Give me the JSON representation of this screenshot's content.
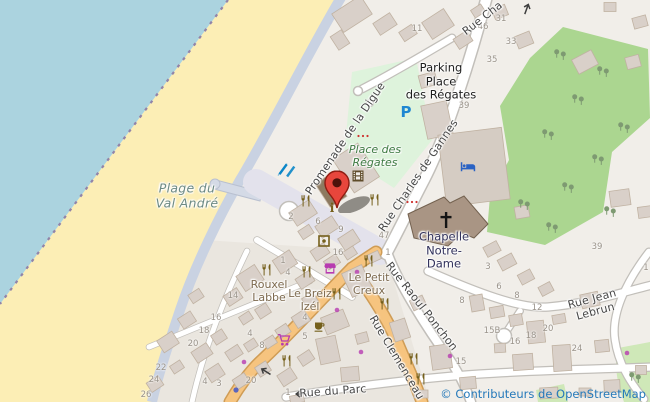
{
  "map": {
    "attribution": "© Contributeurs de OpenStreetMap",
    "colors": {
      "land": "#f1eee9",
      "water": "#abd3df",
      "sand": "#fceeb5",
      "promenade": "#c9d2e2",
      "pedestrian": "#e3e2ec",
      "building": "#d9d0c9",
      "buildingstroke": "#c0b2a2",
      "roadcasing": "#c2bfba",
      "primary": "#f6c47f",
      "primarycasing": "#cf9c55",
      "parkinglot": "#def3dc",
      "garden": "#abd690",
      "grass": "#cfe8b8",
      "boundary": "#9184a8",
      "tint": "#eae6df",
      "streettext": "#474747",
      "housenum": "#9a938a",
      "poibrown": "#7d6a4f",
      "parktext": "#3e7a42",
      "beachtext": "#6d8a84",
      "chapeltext": "#32325c",
      "attr": "#2579ba",
      "gastro": "#75601c",
      "shopmag": "#b73bb0",
      "bedblue": "#2a62c4",
      "sailblue": "#0b86c8",
      "parkblue": "#1f87d2",
      "cinema": "#5f4c2a",
      "treegreen": "#7e9a72",
      "markerred": "#e8463c",
      "markerstroke": "#8f1d12",
      "markerinner": "#4e120b"
    },
    "streets": [
      {
        "name": "Promenade de la Digue"
      },
      {
        "name": "Rue Charles de Gannes"
      },
      {
        "name": "Rue Cha"
      },
      {
        "name": "Rue Raoul Ponchon"
      },
      {
        "name": "Rue Clemenceau"
      },
      {
        "name": "Rue Jean Lebrun"
      },
      {
        "name": "Rue du Parc"
      }
    ],
    "places": [
      {
        "name": "Plage du\nVal André"
      },
      {
        "name": "Parking\nPlace\ndes Régates"
      },
      {
        "name": "Place des\nRégates"
      },
      {
        "name": "Chapelle\nNotre-\nDame"
      },
      {
        "name": "Rouxel\nLabbe"
      },
      {
        "name": "Le Breiz\nIzél"
      },
      {
        "name": "Le Petit\nCreux"
      }
    ],
    "house_numbers": [
      {
        "t": "11",
        "x": 417,
        "y": 29
      },
      {
        "t": "46",
        "x": 483,
        "y": 27
      },
      {
        "t": "31",
        "x": 501,
        "y": 19
      },
      {
        "t": "33",
        "x": 511,
        "y": 42
      },
      {
        "t": "35",
        "x": 492,
        "y": 60
      },
      {
        "t": "39",
        "x": 464,
        "y": 106
      },
      {
        "t": "39",
        "x": 597,
        "y": 247
      },
      {
        "t": "1",
        "x": 646,
        "y": 268
      },
      {
        "t": "2",
        "x": 291,
        "y": 217
      },
      {
        "t": "6",
        "x": 318,
        "y": 222
      },
      {
        "t": "9",
        "x": 341,
        "y": 230
      },
      {
        "t": "16",
        "x": 338,
        "y": 253
      },
      {
        "t": "47",
        "x": 384,
        "y": 236
      },
      {
        "t": "1",
        "x": 388,
        "y": 253
      },
      {
        "t": "1",
        "x": 283,
        "y": 261
      },
      {
        "t": "4",
        "x": 288,
        "y": 273
      },
      {
        "t": "14",
        "x": 233,
        "y": 296
      },
      {
        "t": "16",
        "x": 216,
        "y": 318
      },
      {
        "t": "18",
        "x": 204,
        "y": 331
      },
      {
        "t": "20",
        "x": 193,
        "y": 344
      },
      {
        "t": "4",
        "x": 250,
        "y": 334
      },
      {
        "t": "8",
        "x": 262,
        "y": 346
      },
      {
        "t": "4",
        "x": 305,
        "y": 318
      },
      {
        "t": "5",
        "x": 305,
        "y": 337
      },
      {
        "t": "22",
        "x": 161,
        "y": 368
      },
      {
        "t": "24",
        "x": 154,
        "y": 380
      },
      {
        "t": "26",
        "x": 146,
        "y": 395
      },
      {
        "t": "4",
        "x": 205,
        "y": 382
      },
      {
        "t": "3",
        "x": 219,
        "y": 384
      },
      {
        "t": "20",
        "x": 251,
        "y": 381
      },
      {
        "t": "1",
        "x": 288,
        "y": 393
      },
      {
        "t": "3",
        "x": 488,
        "y": 267
      },
      {
        "t": "6",
        "x": 499,
        "y": 287
      },
      {
        "t": "8",
        "x": 517,
        "y": 296
      },
      {
        "t": "12",
        "x": 537,
        "y": 308
      },
      {
        "t": "8",
        "x": 462,
        "y": 301
      },
      {
        "t": "15B",
        "x": 492,
        "y": 331
      },
      {
        "t": "16",
        "x": 515,
        "y": 342
      },
      {
        "t": "18",
        "x": 531,
        "y": 336
      },
      {
        "t": "20",
        "x": 548,
        "y": 329
      },
      {
        "t": "24",
        "x": 577,
        "y": 349
      },
      {
        "t": "15",
        "x": 461,
        "y": 362
      }
    ],
    "icons": [
      {
        "n": "restaurant",
        "x": 306,
        "y": 201
      },
      {
        "n": "restaurant",
        "x": 375,
        "y": 200
      },
      {
        "n": "restaurant",
        "x": 267,
        "y": 270
      },
      {
        "n": "restaurant",
        "x": 307,
        "y": 272
      },
      {
        "n": "restaurant",
        "x": 337,
        "y": 294
      },
      {
        "n": "restaurant",
        "x": 369,
        "y": 261
      },
      {
        "n": "restaurant",
        "x": 385,
        "y": 304
      },
      {
        "n": "restaurant",
        "x": 287,
        "y": 361
      },
      {
        "n": "restaurant",
        "x": 414,
        "y": 359
      },
      {
        "n": "restaurant",
        "x": 421,
        "y": 379
      },
      {
        "n": "cafe",
        "x": 320,
        "y": 327
      },
      {
        "n": "cinema",
        "x": 358,
        "y": 176
      },
      {
        "n": "info",
        "x": 332,
        "y": 208
      },
      {
        "n": "artwork",
        "x": 324,
        "y": 241
      },
      {
        "n": "supermarket",
        "x": 284,
        "y": 340
      },
      {
        "n": "marketplace",
        "x": 330,
        "y": 268
      },
      {
        "n": "bed",
        "x": 468,
        "y": 167
      },
      {
        "n": "windsurf",
        "x": 288,
        "y": 170
      },
      {
        "n": "cross",
        "x": 446,
        "y": 220
      },
      {
        "n": "parking",
        "x": 406,
        "y": 112
      },
      {
        "n": "flowers",
        "x": 363,
        "y": 136
      },
      {
        "n": "flowers",
        "x": 412,
        "y": 202
      },
      {
        "n": "tree",
        "x": 560,
        "y": 55
      },
      {
        "n": "tree",
        "x": 603,
        "y": 72
      },
      {
        "n": "tree",
        "x": 578,
        "y": 100
      },
      {
        "n": "tree",
        "x": 624,
        "y": 128
      },
      {
        "n": "tree",
        "x": 548,
        "y": 135
      },
      {
        "n": "tree",
        "x": 598,
        "y": 160
      },
      {
        "n": "tree",
        "x": 568,
        "y": 188
      },
      {
        "n": "tree",
        "x": 610,
        "y": 212
      },
      {
        "n": "tree",
        "x": 552,
        "y": 228
      },
      {
        "n": "tree",
        "x": 524,
        "y": 205
      },
      {
        "n": "tree",
        "x": 635,
        "y": 378
      },
      {
        "n": "dot",
        "x": 357,
        "y": 272
      },
      {
        "n": "dot",
        "x": 337,
        "y": 310
      },
      {
        "n": "dot",
        "x": 361,
        "y": 352
      },
      {
        "n": "dot",
        "x": 450,
        "y": 356
      },
      {
        "n": "dot",
        "x": 627,
        "y": 353
      },
      {
        "n": "dot",
        "x": 244,
        "y": 362
      },
      {
        "n": "bluedot",
        "x": 236,
        "y": 390
      },
      {
        "n": "arrow",
        "x": 527,
        "y": 8,
        "r": -70
      },
      {
        "n": "arrow",
        "x": 265,
        "y": 371,
        "r": 212
      },
      {
        "n": "arrow",
        "x": 300,
        "y": 394,
        "r": 180
      }
    ],
    "marker": {
      "color": "#e8463c"
    }
  }
}
